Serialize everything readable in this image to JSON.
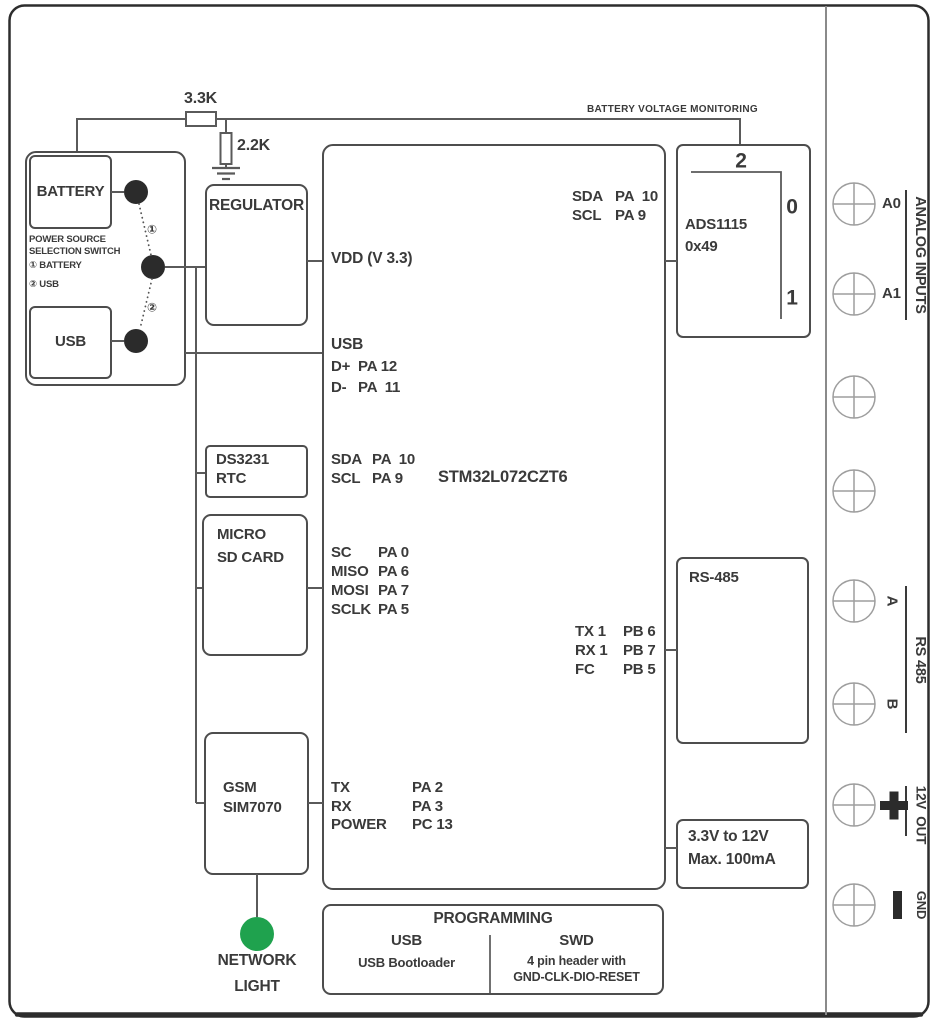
{
  "colors": {
    "ink": "#3a3a3a",
    "line": "#5a5a5a",
    "green": "#1fa24e"
  },
  "monitor": {
    "label": "BATTERY VOLTAGE MONITORING",
    "r_series": "3.3K",
    "r_shunt": "2.2K"
  },
  "switch": {
    "battery": "BATTERY",
    "usb": "USB",
    "caption1": "POWER SOURCE",
    "caption2": "SELECTION SWITCH",
    "opt1": "① BATTERY",
    "opt2": "② USB",
    "mark1": "①",
    "mark2": "②"
  },
  "regulator": {
    "label": "REGULATOR"
  },
  "mcu": {
    "part": "STM32L072CZT6",
    "vdd": "VDD (V 3.3)",
    "usb_title": "USB",
    "usb_pins": [
      {
        "n": "D+",
        "p": "PA 12"
      },
      {
        "n": "D-",
        "p": "PA  11"
      }
    ],
    "i2c_rtc": [
      {
        "n": "SDA",
        "p": "PA  10"
      },
      {
        "n": "SCL",
        "p": "PA 9"
      }
    ],
    "spi": [
      {
        "n": "SC",
        "p": "PA 0"
      },
      {
        "n": "MISO",
        "p": "PA 6"
      },
      {
        "n": "MOSI",
        "p": "PA 7"
      },
      {
        "n": "SCLK",
        "p": "PA 5"
      }
    ],
    "i2c_ads": [
      {
        "n": "SDA",
        "p": "PA  10"
      },
      {
        "n": "SCL",
        "p": "PA 9"
      }
    ],
    "uart_485": [
      {
        "n": "TX 1",
        "p": "PB 6"
      },
      {
        "n": "RX 1",
        "p": "PB 7"
      },
      {
        "n": "FC",
        "p": "PB 5"
      }
    ],
    "uart_gsm": [
      {
        "n": "TX",
        "p": "PA 2"
      },
      {
        "n": "RX",
        "p": "PA 3"
      },
      {
        "n": "POWER",
        "p": "PC 13"
      }
    ]
  },
  "rtc": {
    "l1": "DS3231",
    "l2": "RTC"
  },
  "sd": {
    "l1": "MICRO",
    "l2": "SD CARD"
  },
  "gsm": {
    "l1": "GSM",
    "l2": "SIM7070"
  },
  "network_light": {
    "l1": "NETWORK",
    "l2": "LIGHT"
  },
  "ads": {
    "l1": "ADS1115",
    "l2": "0x49",
    "ch2": "2",
    "ch0": "0",
    "ch1": "1"
  },
  "rs485": {
    "label": "RS-485"
  },
  "boost": {
    "l1": "3.3V to 12V",
    "l2": "Max. 100mA"
  },
  "terminals": {
    "a0": "A0",
    "a1": "A1",
    "analog_group": "ANALOG INPUTS",
    "a": "A",
    "b": "B",
    "rs485_group": "RS 485",
    "out_group": "12V  OUT",
    "plus_symbol": "+",
    "minus_symbol": "−",
    "gnd": "GND"
  },
  "programming": {
    "title": "PROGRAMMING",
    "usb": "USB",
    "usb_desc": "USB Bootloader",
    "swd": "SWD",
    "swd_desc1": "4 pin header with",
    "swd_desc2": "GND-CLK-DIO-RESET"
  }
}
